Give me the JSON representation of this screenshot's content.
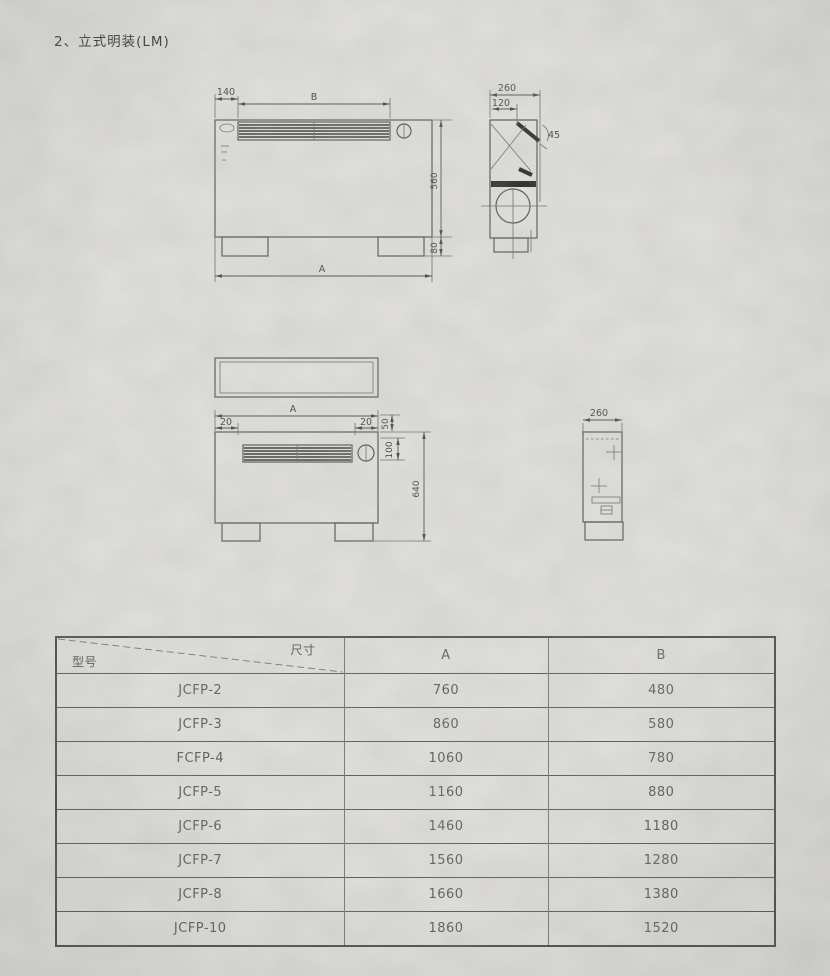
{
  "page": {
    "title": "2、立式明装(LM)"
  },
  "drawings": {
    "front_view": {
      "dim_grille_offset": "140",
      "dim_grille_width": "B",
      "dim_body_height": "560",
      "dim_foot_height": "80",
      "dim_total_width": "A"
    },
    "side_view": {
      "dim_depth": "260",
      "dim_outlet": "120",
      "dim_angle": "45"
    },
    "front_view_lower": {
      "dim_total_width": "A",
      "dim_left_margin": "20",
      "dim_right_margin": "20",
      "dim_top_offset": "50",
      "dim_grille_height": "100",
      "dim_total_height": "640"
    },
    "side_view_lower": {
      "dim_depth": "260"
    }
  },
  "table": {
    "header": {
      "model_label": "型号",
      "size_label": "尺寸",
      "col_a": "A",
      "col_b": "B"
    },
    "rows": [
      {
        "model": "JCFP-2",
        "a": "760",
        "b": "480"
      },
      {
        "model": "JCFP-3",
        "a": "860",
        "b": "580"
      },
      {
        "model": "FCFP-4",
        "a": "1060",
        "b": "780"
      },
      {
        "model": "JCFP-5",
        "a": "1160",
        "b": "880"
      },
      {
        "model": "JCFP-6",
        "a": "1460",
        "b": "1180"
      },
      {
        "model": "JCFP-7",
        "a": "1560",
        "b": "1280"
      },
      {
        "model": "JCFP-8",
        "a": "1660",
        "b": "1380"
      },
      {
        "model": "JCFP-10",
        "a": "1860",
        "b": "1520"
      }
    ]
  }
}
